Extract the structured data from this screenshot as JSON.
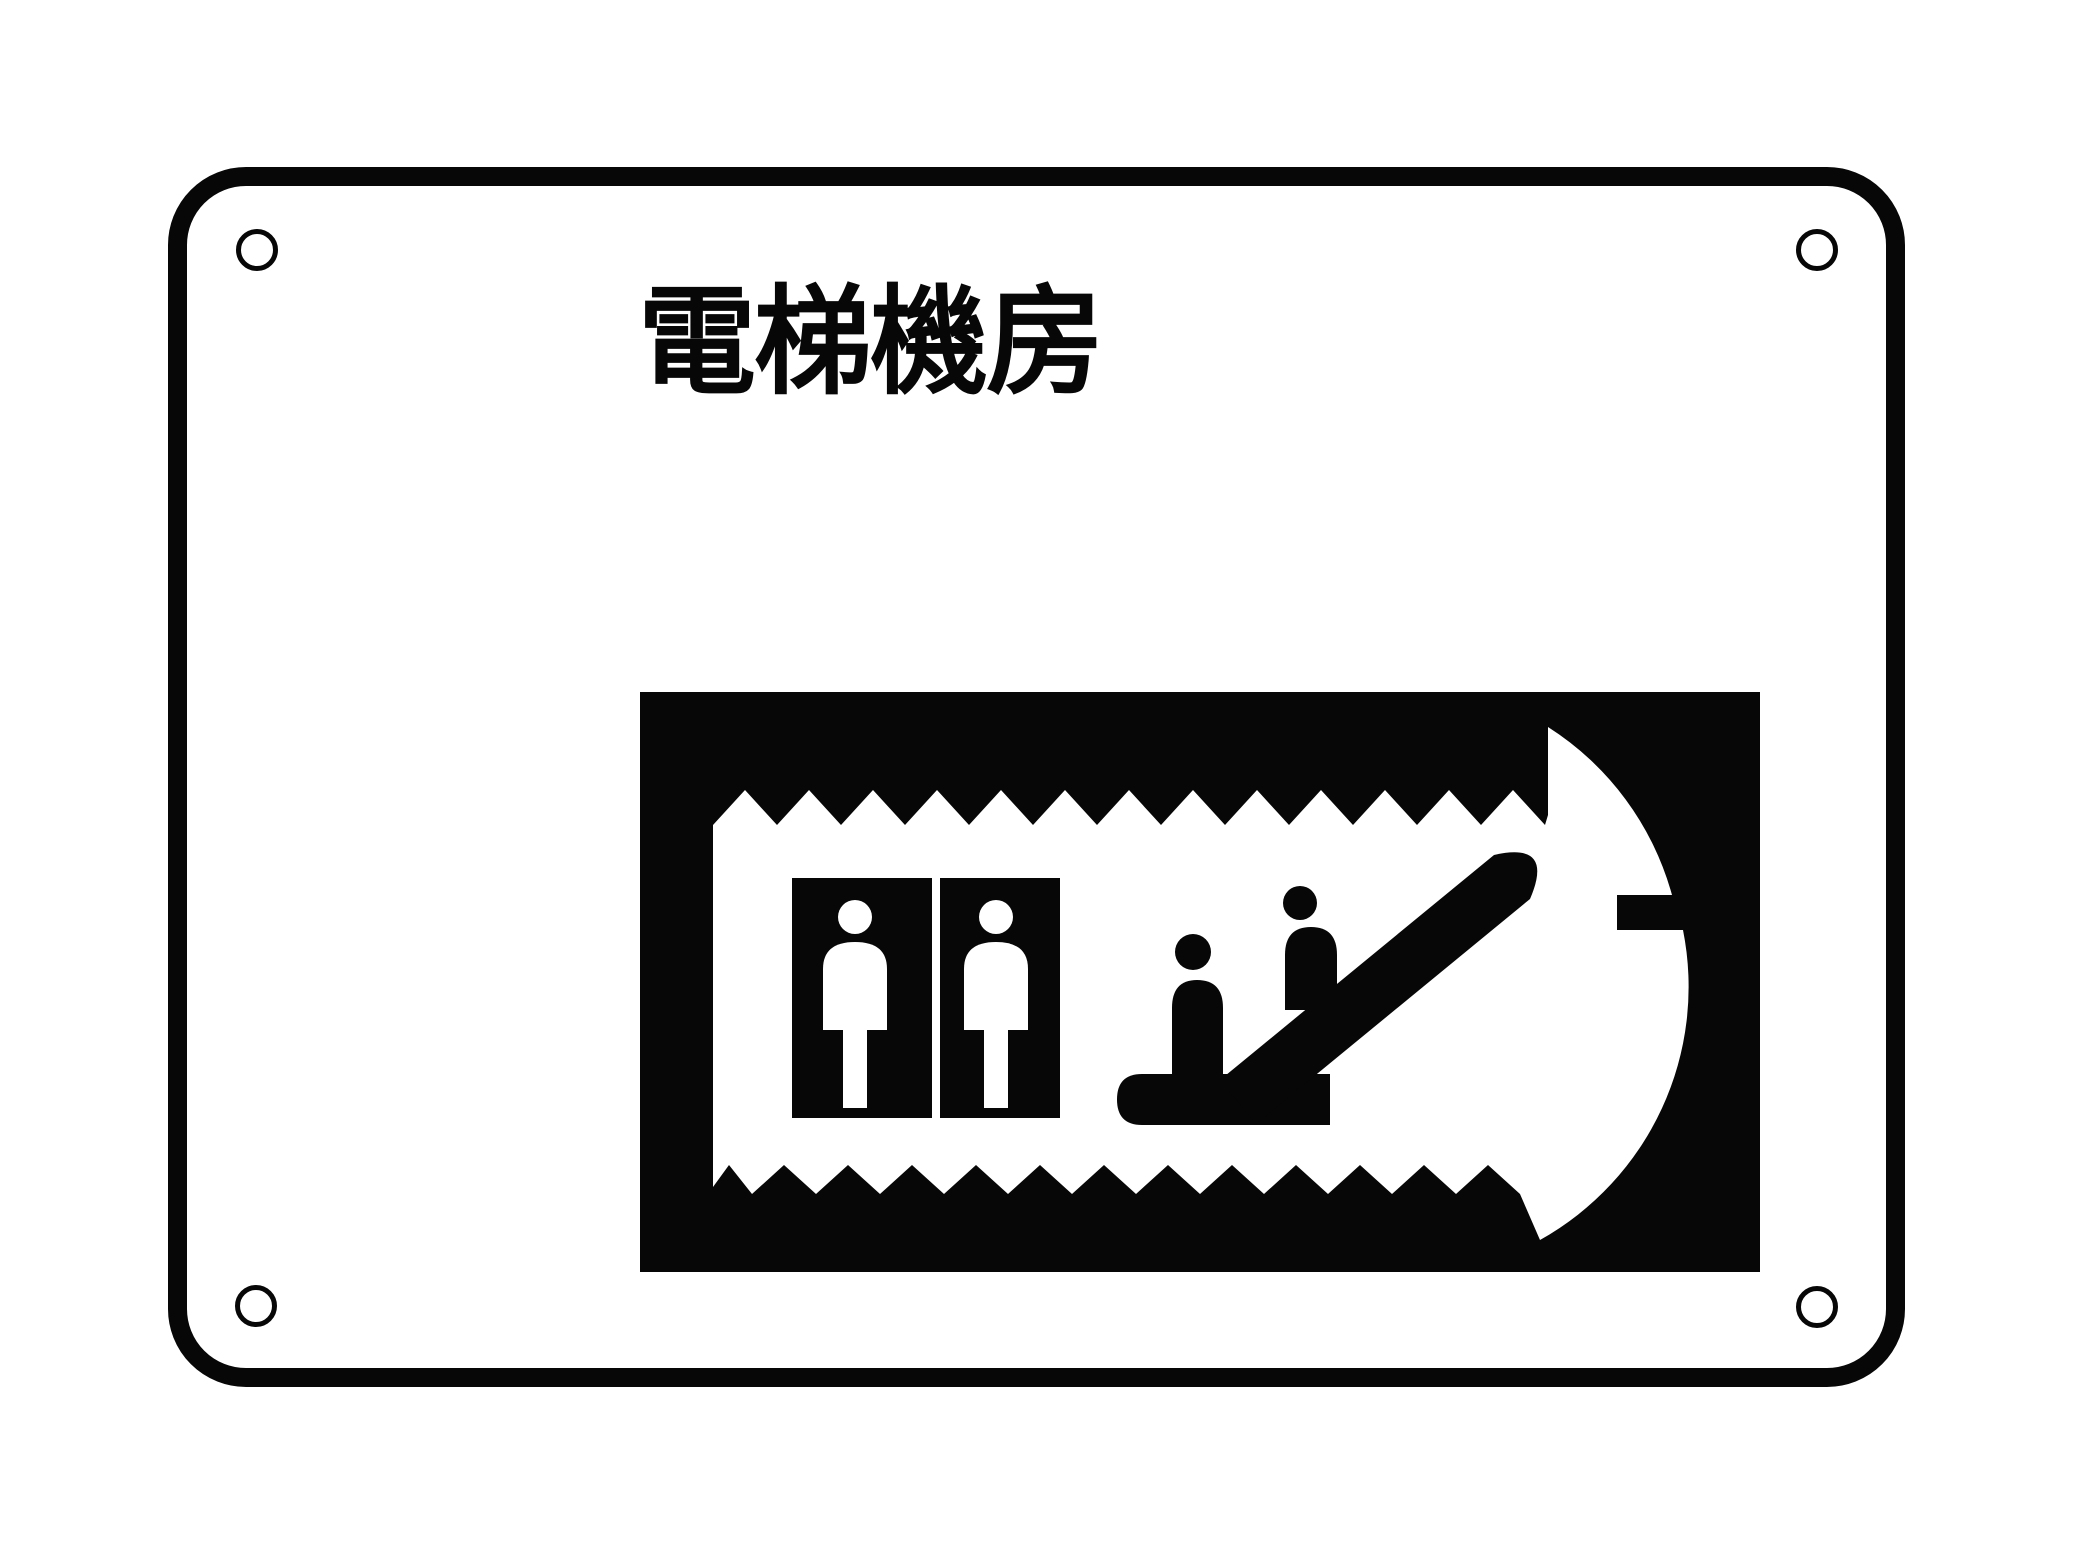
{
  "sign": {
    "title": "電梯機房",
    "colors": {
      "ink": "#070707",
      "plate": "#ffffff"
    },
    "pictogram": {
      "name": "elevator-escalator-pictogram",
      "description": "Two elevator cars with standing passengers beside two people riding an ascending escalator, framed by a circular arrow pointing up-right with a notch on the right side"
    }
  }
}
